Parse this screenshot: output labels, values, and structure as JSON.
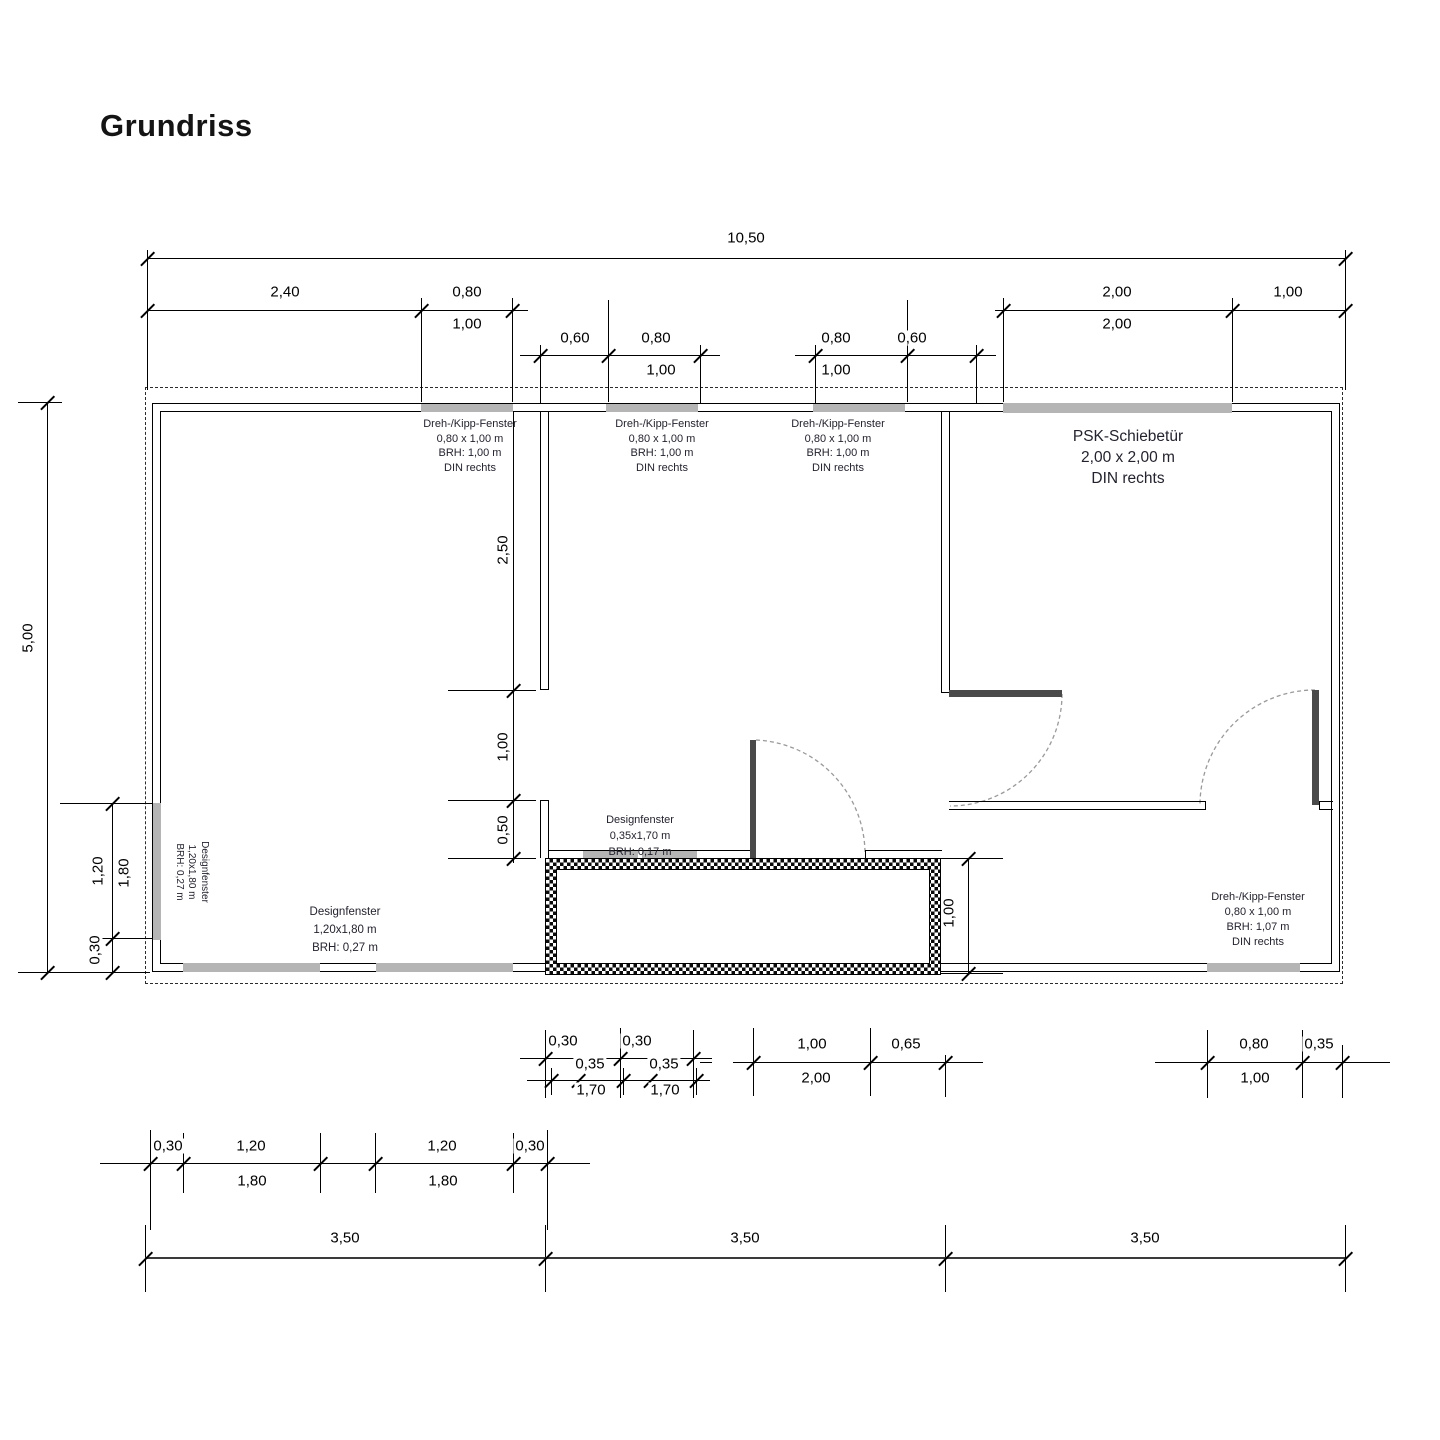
{
  "title": "Grundriss",
  "colors": {
    "wall": "#000000",
    "window_strip": "#b5b5b5",
    "door_leaf": "#4a4a4a",
    "door_arc": "#9a9a9a"
  },
  "dims": {
    "top_overall": "10,50",
    "top_left": [
      "2,40",
      "0,80"
    ],
    "top_left_sub": "1,00",
    "top_right": [
      "2,00",
      "1,00"
    ],
    "top_right_sub": "2,00",
    "mid_left": [
      "0,60",
      "0,80"
    ],
    "mid_left_sub": "1,00",
    "mid_right": [
      "0,80",
      "0,60"
    ],
    "mid_right_sub": "1,00",
    "left_overall": "5,00",
    "left_chain": [
      "1,20",
      "1,80",
      "0,30"
    ],
    "interior_chain": [
      "2,50",
      "1,00",
      "0,50"
    ],
    "box_height": "1,00",
    "bottom1_left": [
      "0,30",
      "0,30",
      "0,35",
      "0,35",
      "1,70",
      "1,70"
    ],
    "bottom1_mid": [
      "1,00",
      "0,65",
      "2,00"
    ],
    "bottom1_right": [
      "0,80",
      "0,35",
      "1,00"
    ],
    "bottom2": [
      "0,30",
      "1,20",
      "1,20",
      "0,30",
      "1,80",
      "1,80"
    ],
    "bottom3": [
      "3,50",
      "3,50",
      "3,50"
    ]
  },
  "labels": {
    "window_top_left": {
      "lines": [
        "Dreh-/Kipp-Fenster",
        "0,80 x 1,00 m",
        "BRH: 1,00 m",
        "DIN rechts"
      ]
    },
    "window_top_mid": {
      "lines": [
        "Dreh-/Kipp-Fenster",
        "0,80 x 1,00 m",
        "BRH: 1,00 m",
        "DIN rechts"
      ]
    },
    "window_top_right": {
      "lines": [
        "Dreh-/Kipp-Fenster",
        "0,80 x 1,00 m",
        "BRH: 1,00 m",
        "DIN rechts"
      ]
    },
    "psk_door": {
      "lines": [
        "PSK-Schiebetür",
        "2,00 x 2,00 m",
        "DIN rechts"
      ]
    },
    "design_left_rotated": {
      "lines": [
        "Designfenster",
        "1,20x1,80 m",
        "BRH: 0,27 m"
      ]
    },
    "design_bottom_left": {
      "lines": [
        "Designfenster",
        "1,20x1,80 m",
        "BRH: 0,27 m"
      ]
    },
    "design_mid": {
      "lines": [
        "Designfenster",
        "0,35x1,70 m",
        "BRH: 0,17 m"
      ]
    },
    "window_bottom_right": {
      "lines": [
        "Dreh-/Kipp-Fenster",
        "0,80 x 1,00 m",
        "BRH: 1,07 m",
        "DIN rechts"
      ]
    }
  }
}
